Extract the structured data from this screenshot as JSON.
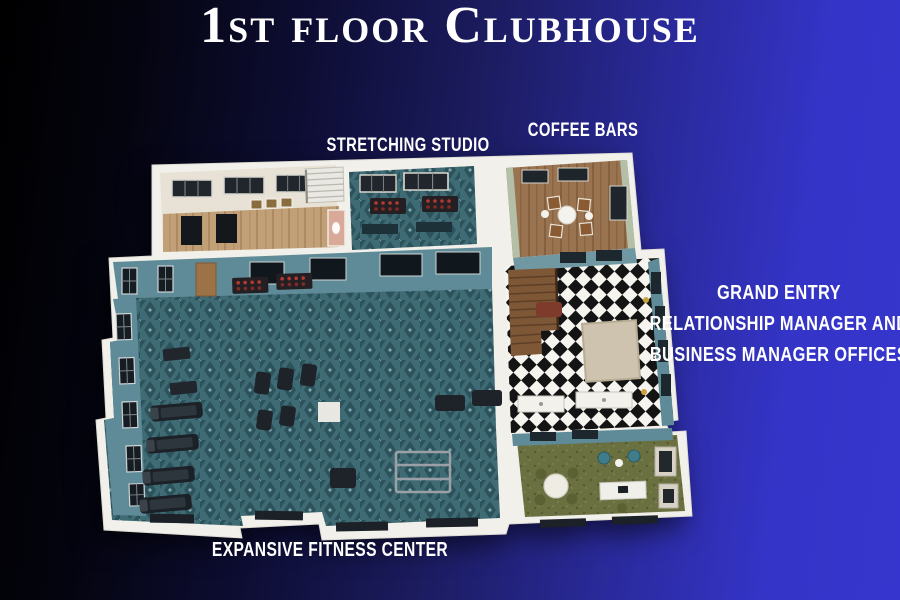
{
  "title": "1st floor Clubhouse",
  "labels": {
    "stretching_studio": "Stretching Studio",
    "coffee_bars": "Coffee Bars",
    "grand_entry_line1": "Grand Entry",
    "grand_entry_line2": "Relationship Manager and",
    "grand_entry_line3": "Business Manager Offices",
    "fitness_center": "Expansive Fitness Center"
  },
  "floorplan": {
    "view": "3d-isometric-top-down",
    "rooms": [
      {
        "id": "expansive-fitness-center",
        "label": "Expansive Fitness Center",
        "floor": "teal patterned carpet",
        "floor_color": "#3f6b75",
        "contents": "treadmills, cardio machines, dumbbell racks, squat rack"
      },
      {
        "id": "stretching-studio",
        "label": "Stretching Studio",
        "floor": "teal patterned carpet",
        "floor_color": "#3f6b75",
        "contents": "dumbbell racks, stretch mats, windows"
      },
      {
        "id": "coffee-bars",
        "label": "Coffee Bars",
        "floor": "wood",
        "floor_color": "#9a7350",
        "contents": "round table with four chairs, shelving"
      },
      {
        "id": "grand-entry",
        "label": "Grand Entry",
        "floor": "black and white checkerboard",
        "floor_colors": [
          "#111111",
          "#f5f5f0"
        ],
        "contents": "wood staircase, area rug, reception counters"
      },
      {
        "id": "manager-offices",
        "label": "Relationship Manager and Business Manager Offices",
        "floor": "olive carpet",
        "floor_color": "#6b7041",
        "contents": "round meeting table, desk, armchairs, cabinets"
      }
    ]
  },
  "colors": {
    "background_left": "#000000",
    "background_right": "#3636ce",
    "title_text": "#ffffff",
    "label_text": "#ffffff",
    "wall_white": "#f2f0ea",
    "interior_wall_teal": "#5e8b97",
    "carpet_teal": "#3f6b75",
    "wood_brown": "#9a7350",
    "office_olive": "#6b7041",
    "checker_black": "#141414",
    "checker_white": "#f5f4ee"
  }
}
